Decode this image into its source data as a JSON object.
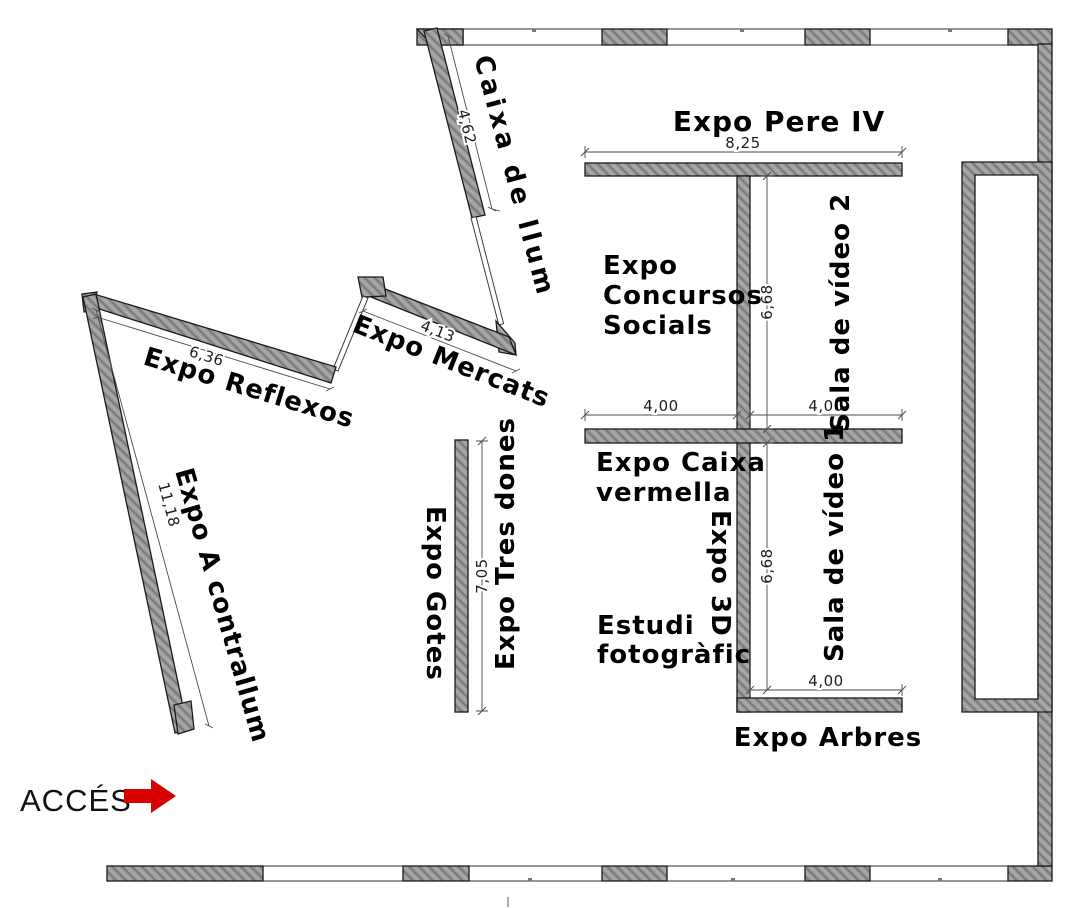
{
  "plan_title": "Exhibition floor plan",
  "rooms": {
    "caixa_de_llum": "Caixa de llum",
    "expo_pere_iv": "Expo Pere IV",
    "expo_concursos": [
      "Expo",
      "Concursos",
      "Socials"
    ],
    "sala_video_2": "Sala de vídeo 2",
    "expo_mercats": "Expo Mercats",
    "expo_reflexos": "Expo Reflexos",
    "expo_a_contrallum": "Expo A contrallum",
    "expo_gotes": "Expo Gotes",
    "expo_tres_dones": "Expo Tres dones",
    "expo_caixa_vermella": [
      "Expo Caixa",
      "vermella"
    ],
    "expo_3d": "Expo 3D",
    "sala_video_1": "Sala de vídeo 1",
    "estudi_fotografic": [
      "Estudi",
      "fotogràfic"
    ],
    "expo_arbres": "Expo Arbres"
  },
  "dimensions": {
    "caixa": "4,62",
    "pere_iv": "8,25",
    "mercats": "4,13",
    "reflexos": "6,36",
    "contrallum": "11,18",
    "tres_dones": "7,05",
    "video2_height": "6,68",
    "video1_height": "6,68",
    "concursos_width": "4,00",
    "video2_width": "4,00",
    "video1_width": "4,00"
  },
  "access": {
    "label": "ACCÉS",
    "arrow_color": "#d80000"
  },
  "colors": {
    "wall_fill": "#9c9c9c",
    "wall_hatch": "#737373",
    "outline": "#1a1a1a",
    "dim_color": "#4a4a4a",
    "window": "#ffffff",
    "text": "#000000"
  }
}
